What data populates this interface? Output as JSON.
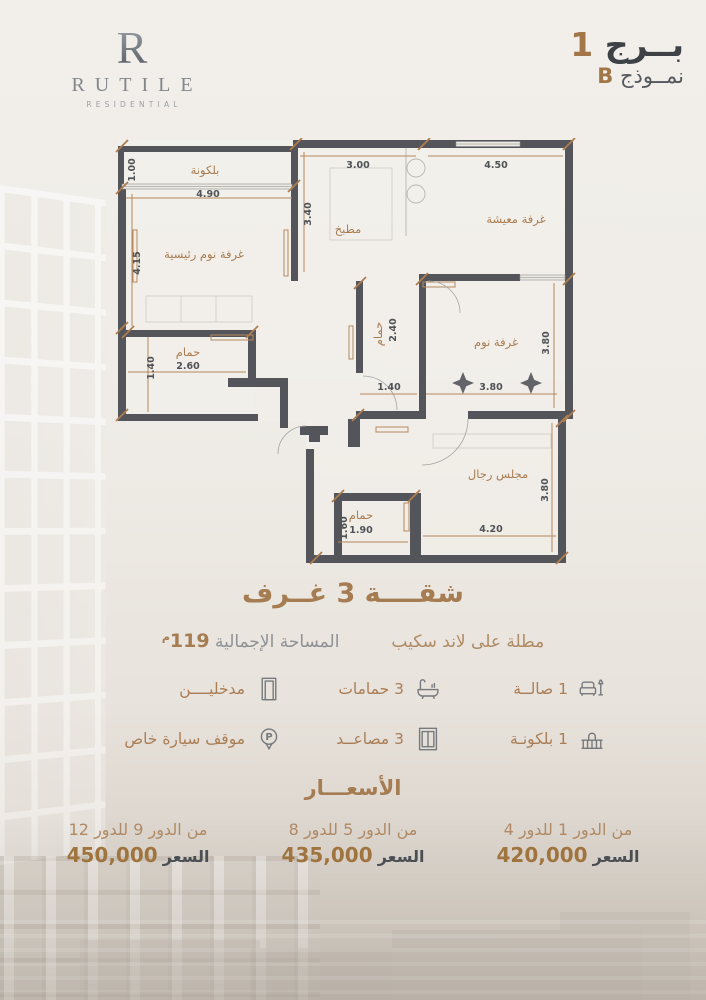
{
  "brand": {
    "monogram": "R",
    "name": "RUTILE",
    "subtitle": "RESIDENTIAL"
  },
  "header": {
    "tower_label": "بــرج",
    "tower_number": "1",
    "model_label": "نمــوذج",
    "model_letter": "B"
  },
  "plan": {
    "labels": {
      "balcony": "بلكونة",
      "master_bedroom": "غرفة نوم رئيسية",
      "kitchen": "مطبخ",
      "living": "غرفة معيشة",
      "bedroom": "غرفة نوم",
      "bath_mid": "حمام",
      "bath_left": "حمام",
      "majlis": "مجلس رجال",
      "bath_bottom": "حمام"
    },
    "dims": {
      "balcony_h": "1.00",
      "balcony_w": "4.90",
      "master_h": "4.15",
      "kitchen_w": "3.00",
      "kitchen_h": "3.40",
      "living_w": "4.50",
      "bedroom_w": "3.80",
      "bedroom_h": "3.80",
      "bath_mid_h": "2.40",
      "bath_mid_w": "1.40",
      "bath_left_w": "2.60",
      "bath_left_h": "1.40",
      "majlis_w": "4.20",
      "majlis_h": "3.80",
      "bath_bottom_w": "1.90",
      "bath_bottom_h": "1.60"
    }
  },
  "summary": {
    "title": "شقــــة 3 غــرف",
    "view": "مطلة على لاند سكيب",
    "area_label": "المساحة الإجمالية",
    "area_value": "119",
    "area_unit": "م"
  },
  "features": [
    {
      "icon": "sofa-icon",
      "label": "1 صالــة"
    },
    {
      "icon": "bathtub-icon",
      "label": "3 حمامات"
    },
    {
      "icon": "door-icon",
      "label": "مدخليــــن"
    },
    {
      "icon": "balcony-icon",
      "label": "1 بلكونـة"
    },
    {
      "icon": "elevator-icon",
      "label": "3 مصاعــد"
    },
    {
      "icon": "parking-icon",
      "label": "موقف سيارة خاص"
    }
  ],
  "icons": {
    "parking_letter": "P"
  },
  "prices": {
    "title": "الأسعـــار",
    "tiers": [
      {
        "floors": "من الدور 1 للدور 4",
        "price_label": "السعر",
        "price": "420,000"
      },
      {
        "floors": "من الدور 5 للدور 8",
        "price_label": "السعر",
        "price": "435,000"
      },
      {
        "floors": "من الدور 9 للدور 12",
        "price_label": "السعر",
        "price": "450,000"
      }
    ]
  },
  "colors": {
    "accent": "#a67c52",
    "accent_light": "#b08a64",
    "wall": "#54555a",
    "dark": "#3e4247",
    "background": "#efece7"
  }
}
